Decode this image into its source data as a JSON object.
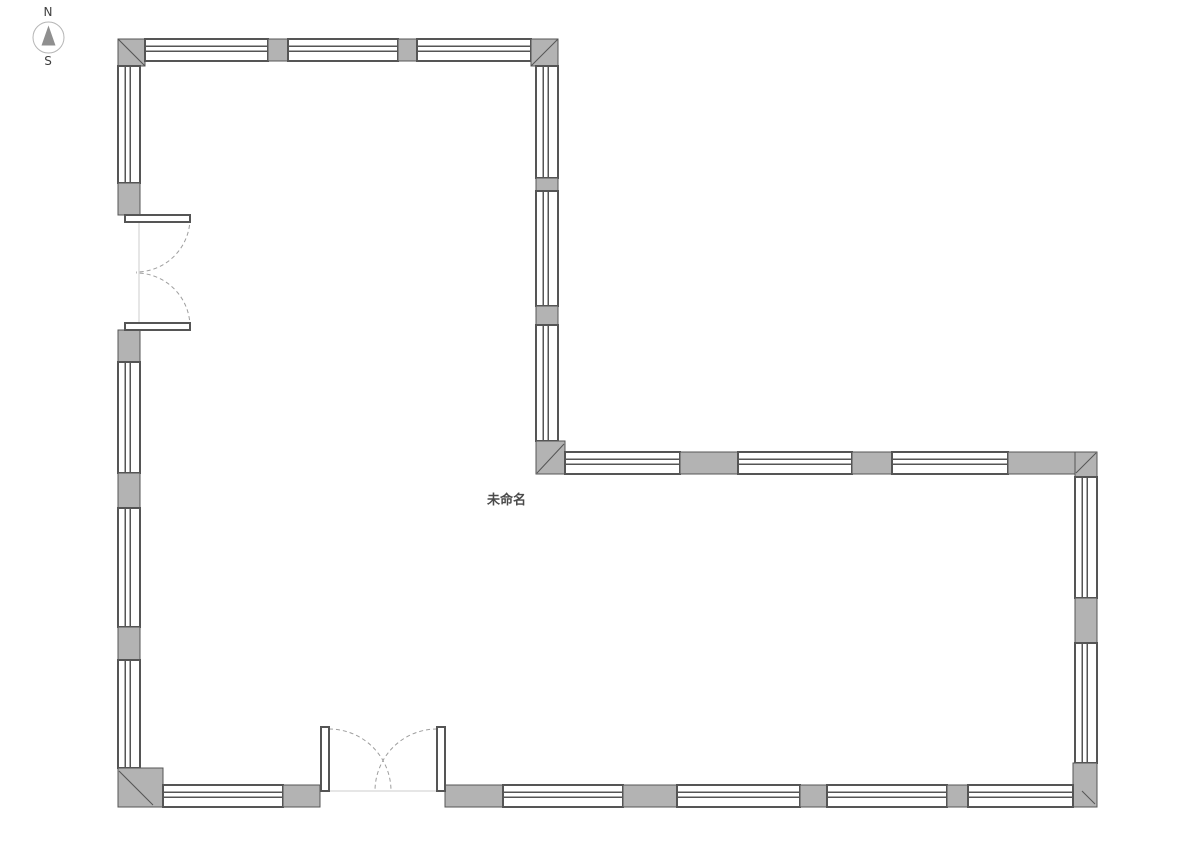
{
  "compass": {
    "north_label": "N",
    "south_label": "S"
  },
  "room": {
    "label": "未命名",
    "x": 487,
    "y": 489
  },
  "colors": {
    "background": "#ffffff",
    "wall_fill": "#b3b3b3",
    "wall_stroke": "#555555",
    "window_fill": "#ffffff",
    "door_arc": "#9e9e9e",
    "threshold_line": "#cccccc",
    "compass_ring": "#b5b5b5",
    "compass_needle": "#8f8f8f",
    "compass_text": "#3f3f3f",
    "label_color": "#4a4a4a"
  },
  "floorplan": {
    "canvas_width": 1191,
    "canvas_height": 842,
    "wall_thickness": 22,
    "walls": [
      {
        "name": "north-wall",
        "orientation": "h",
        "band": [
          39,
          61
        ],
        "segments": [
          {
            "type": "corner",
            "rect": [
              118,
              39,
              27,
              27
            ],
            "diag": [
              118,
              39,
              145,
              66
            ]
          },
          {
            "type": "window",
            "from": 145,
            "to": 268
          },
          {
            "type": "pier",
            "from": 268,
            "to": 288
          },
          {
            "type": "window",
            "from": 288,
            "to": 398
          },
          {
            "type": "pier",
            "from": 398,
            "to": 417
          },
          {
            "type": "window",
            "from": 417,
            "to": 531
          },
          {
            "type": "corner",
            "rect": [
              531,
              39,
              27,
              27
            ],
            "diag": [
              558,
              39,
              531,
              66
            ]
          }
        ]
      },
      {
        "name": "west-wall",
        "orientation": "v",
        "band": [
          118,
          140
        ],
        "segments": [
          {
            "type": "window",
            "from": 66,
            "to": 183
          },
          {
            "type": "pier",
            "from": 183,
            "to": 215
          },
          {
            "type": "gap",
            "from": 215,
            "to": 330
          },
          {
            "type": "pier",
            "from": 330,
            "to": 362
          },
          {
            "type": "window",
            "from": 362,
            "to": 473
          },
          {
            "type": "pier",
            "from": 473,
            "to": 508
          },
          {
            "type": "window",
            "from": 508,
            "to": 627
          },
          {
            "type": "pier",
            "from": 627,
            "to": 660
          },
          {
            "type": "window",
            "from": 660,
            "to": 768
          },
          {
            "type": "corner",
            "rect": [
              118,
              768,
              45,
              39
            ],
            "diag": [
              119,
              771,
              153,
              805
            ]
          }
        ]
      },
      {
        "name": "inner-east-wall-upper",
        "orientation": "v",
        "band": [
          536,
          558
        ],
        "segments": [
          {
            "type": "window",
            "from": 66,
            "to": 178
          },
          {
            "type": "pier",
            "from": 178,
            "to": 191
          },
          {
            "type": "window",
            "from": 191,
            "to": 306
          },
          {
            "type": "pier",
            "from": 306,
            "to": 325
          },
          {
            "type": "window",
            "from": 325,
            "to": 441
          },
          {
            "type": "corner",
            "rect": [
              536,
              441,
              29,
              33
            ],
            "diag": [
              537,
              473,
              564,
              444
            ]
          }
        ]
      },
      {
        "name": "middle-north-wall-right-wing",
        "orientation": "h",
        "band": [
          452,
          474
        ],
        "segments": [
          {
            "type": "window",
            "from": 565,
            "to": 680
          },
          {
            "type": "pier",
            "from": 680,
            "to": 738
          },
          {
            "type": "window",
            "from": 738,
            "to": 852
          },
          {
            "type": "pier",
            "from": 852,
            "to": 892
          },
          {
            "type": "window",
            "from": 892,
            "to": 1008
          },
          {
            "type": "solid",
            "from": 1008,
            "to": 1075
          },
          {
            "type": "corner",
            "rect": [
              1075,
              452,
              22,
              25
            ],
            "diag": [
              1096,
              453,
              1076,
              473
            ]
          }
        ]
      },
      {
        "name": "east-wall",
        "orientation": "v",
        "band": [
          1075,
          1097
        ],
        "segments": [
          {
            "type": "window",
            "from": 477,
            "to": 598
          },
          {
            "type": "pier",
            "from": 598,
            "to": 643
          },
          {
            "type": "window",
            "from": 643,
            "to": 763
          },
          {
            "type": "corner",
            "rect": [
              1073,
              763,
              24,
              44
            ],
            "diag": [
              1082,
              791,
              1095,
              804
            ]
          }
        ]
      },
      {
        "name": "south-wall",
        "orientation": "h",
        "band": [
          785,
          807
        ],
        "segments": [
          {
            "type": "window",
            "from": 163,
            "to": 283
          },
          {
            "type": "pier",
            "from": 283,
            "to": 320
          },
          {
            "type": "gap",
            "from": 320,
            "to": 445
          },
          {
            "type": "pier",
            "from": 445,
            "to": 503
          },
          {
            "type": "window",
            "from": 503,
            "to": 623
          },
          {
            "type": "pier",
            "from": 623,
            "to": 677
          },
          {
            "type": "window",
            "from": 677,
            "to": 800
          },
          {
            "type": "pier",
            "from": 800,
            "to": 827
          },
          {
            "type": "window",
            "from": 827,
            "to": 947
          },
          {
            "type": "pier",
            "from": 947,
            "to": 968
          },
          {
            "type": "window",
            "from": 968,
            "to": 1073
          }
        ]
      }
    ],
    "doors": [
      {
        "name": "west-double-door",
        "panels": [
          {
            "x": 125,
            "y": 215,
            "w": 65,
            "h": 7
          },
          {
            "x": 125,
            "y": 323,
            "w": 65,
            "h": 7
          }
        ],
        "arcs": [
          "M 190 218 A 54 54 0 0 1 136 272",
          "M 190 327 A 54 54 0 0 0 136 273"
        ],
        "threshold": [
          139,
          215,
          139,
          330
        ]
      },
      {
        "name": "south-double-door",
        "panels": [
          {
            "x": 321,
            "y": 727,
            "w": 8,
            "h": 64
          },
          {
            "x": 437,
            "y": 727,
            "w": 8,
            "h": 64
          }
        ],
        "arcs": [
          "M 329 729 A 62 62 0 0 1 391 791",
          "M 437 729 A 62 62 0 0 0 375 791"
        ],
        "threshold": [
          320,
          791,
          445,
          791
        ]
      }
    ]
  }
}
